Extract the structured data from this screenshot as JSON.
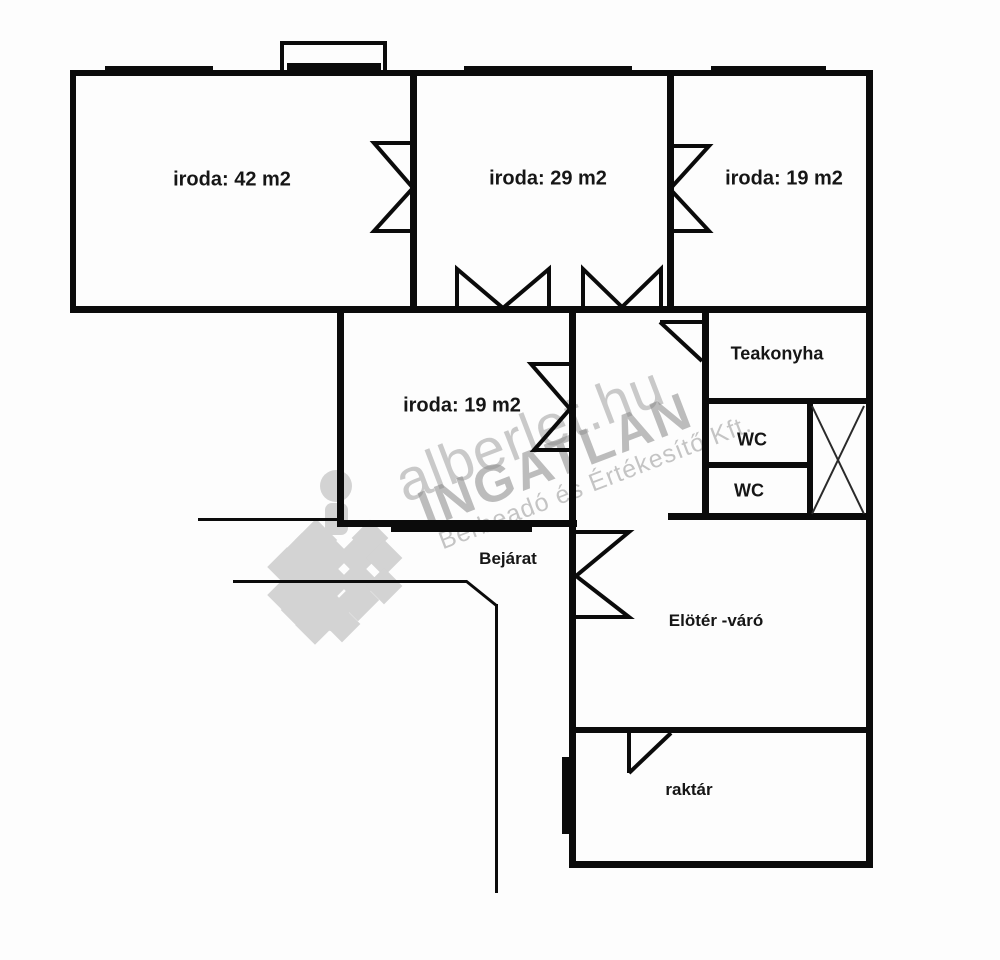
{
  "plan": {
    "rooms": [
      {
        "id": "office-42",
        "label": "iroda: 42 m2",
        "x": 232,
        "y": 180,
        "size": 20
      },
      {
        "id": "office-29",
        "label": "iroda: 29 m2",
        "x": 548,
        "y": 179,
        "size": 20
      },
      {
        "id": "office-19-top",
        "label": "iroda: 19 m2",
        "x": 784,
        "y": 179,
        "size": 20
      },
      {
        "id": "office-19-mid",
        "label": "iroda: 19 m2",
        "x": 462,
        "y": 406,
        "size": 20
      },
      {
        "id": "teakonyha",
        "label": "Teakonyha",
        "x": 777,
        "y": 354,
        "size": 18
      },
      {
        "id": "wc-1",
        "label": "WC",
        "x": 752,
        "y": 440,
        "size": 18
      },
      {
        "id": "wc-2",
        "label": "WC",
        "x": 749,
        "y": 491,
        "size": 18
      },
      {
        "id": "bejarat",
        "label": "Bejárat",
        "x": 508,
        "y": 559,
        "size": 17
      },
      {
        "id": "eloter-varo",
        "label": "Elötér -váró",
        "x": 716,
        "y": 621,
        "size": 17
      },
      {
        "id": "raktar",
        "label": "raktár",
        "x": 689,
        "y": 790,
        "size": 17
      }
    ],
    "watermark": {
      "line1": "alberlet.hu",
      "line2": "INGATLAN",
      "line3": "Bérbeadó és Értékesítő Kft."
    },
    "colors": {
      "wall": "#0b0b0b",
      "label": "#161616",
      "watermark_gray": "#969696",
      "background": "#fdfdfd"
    }
  }
}
